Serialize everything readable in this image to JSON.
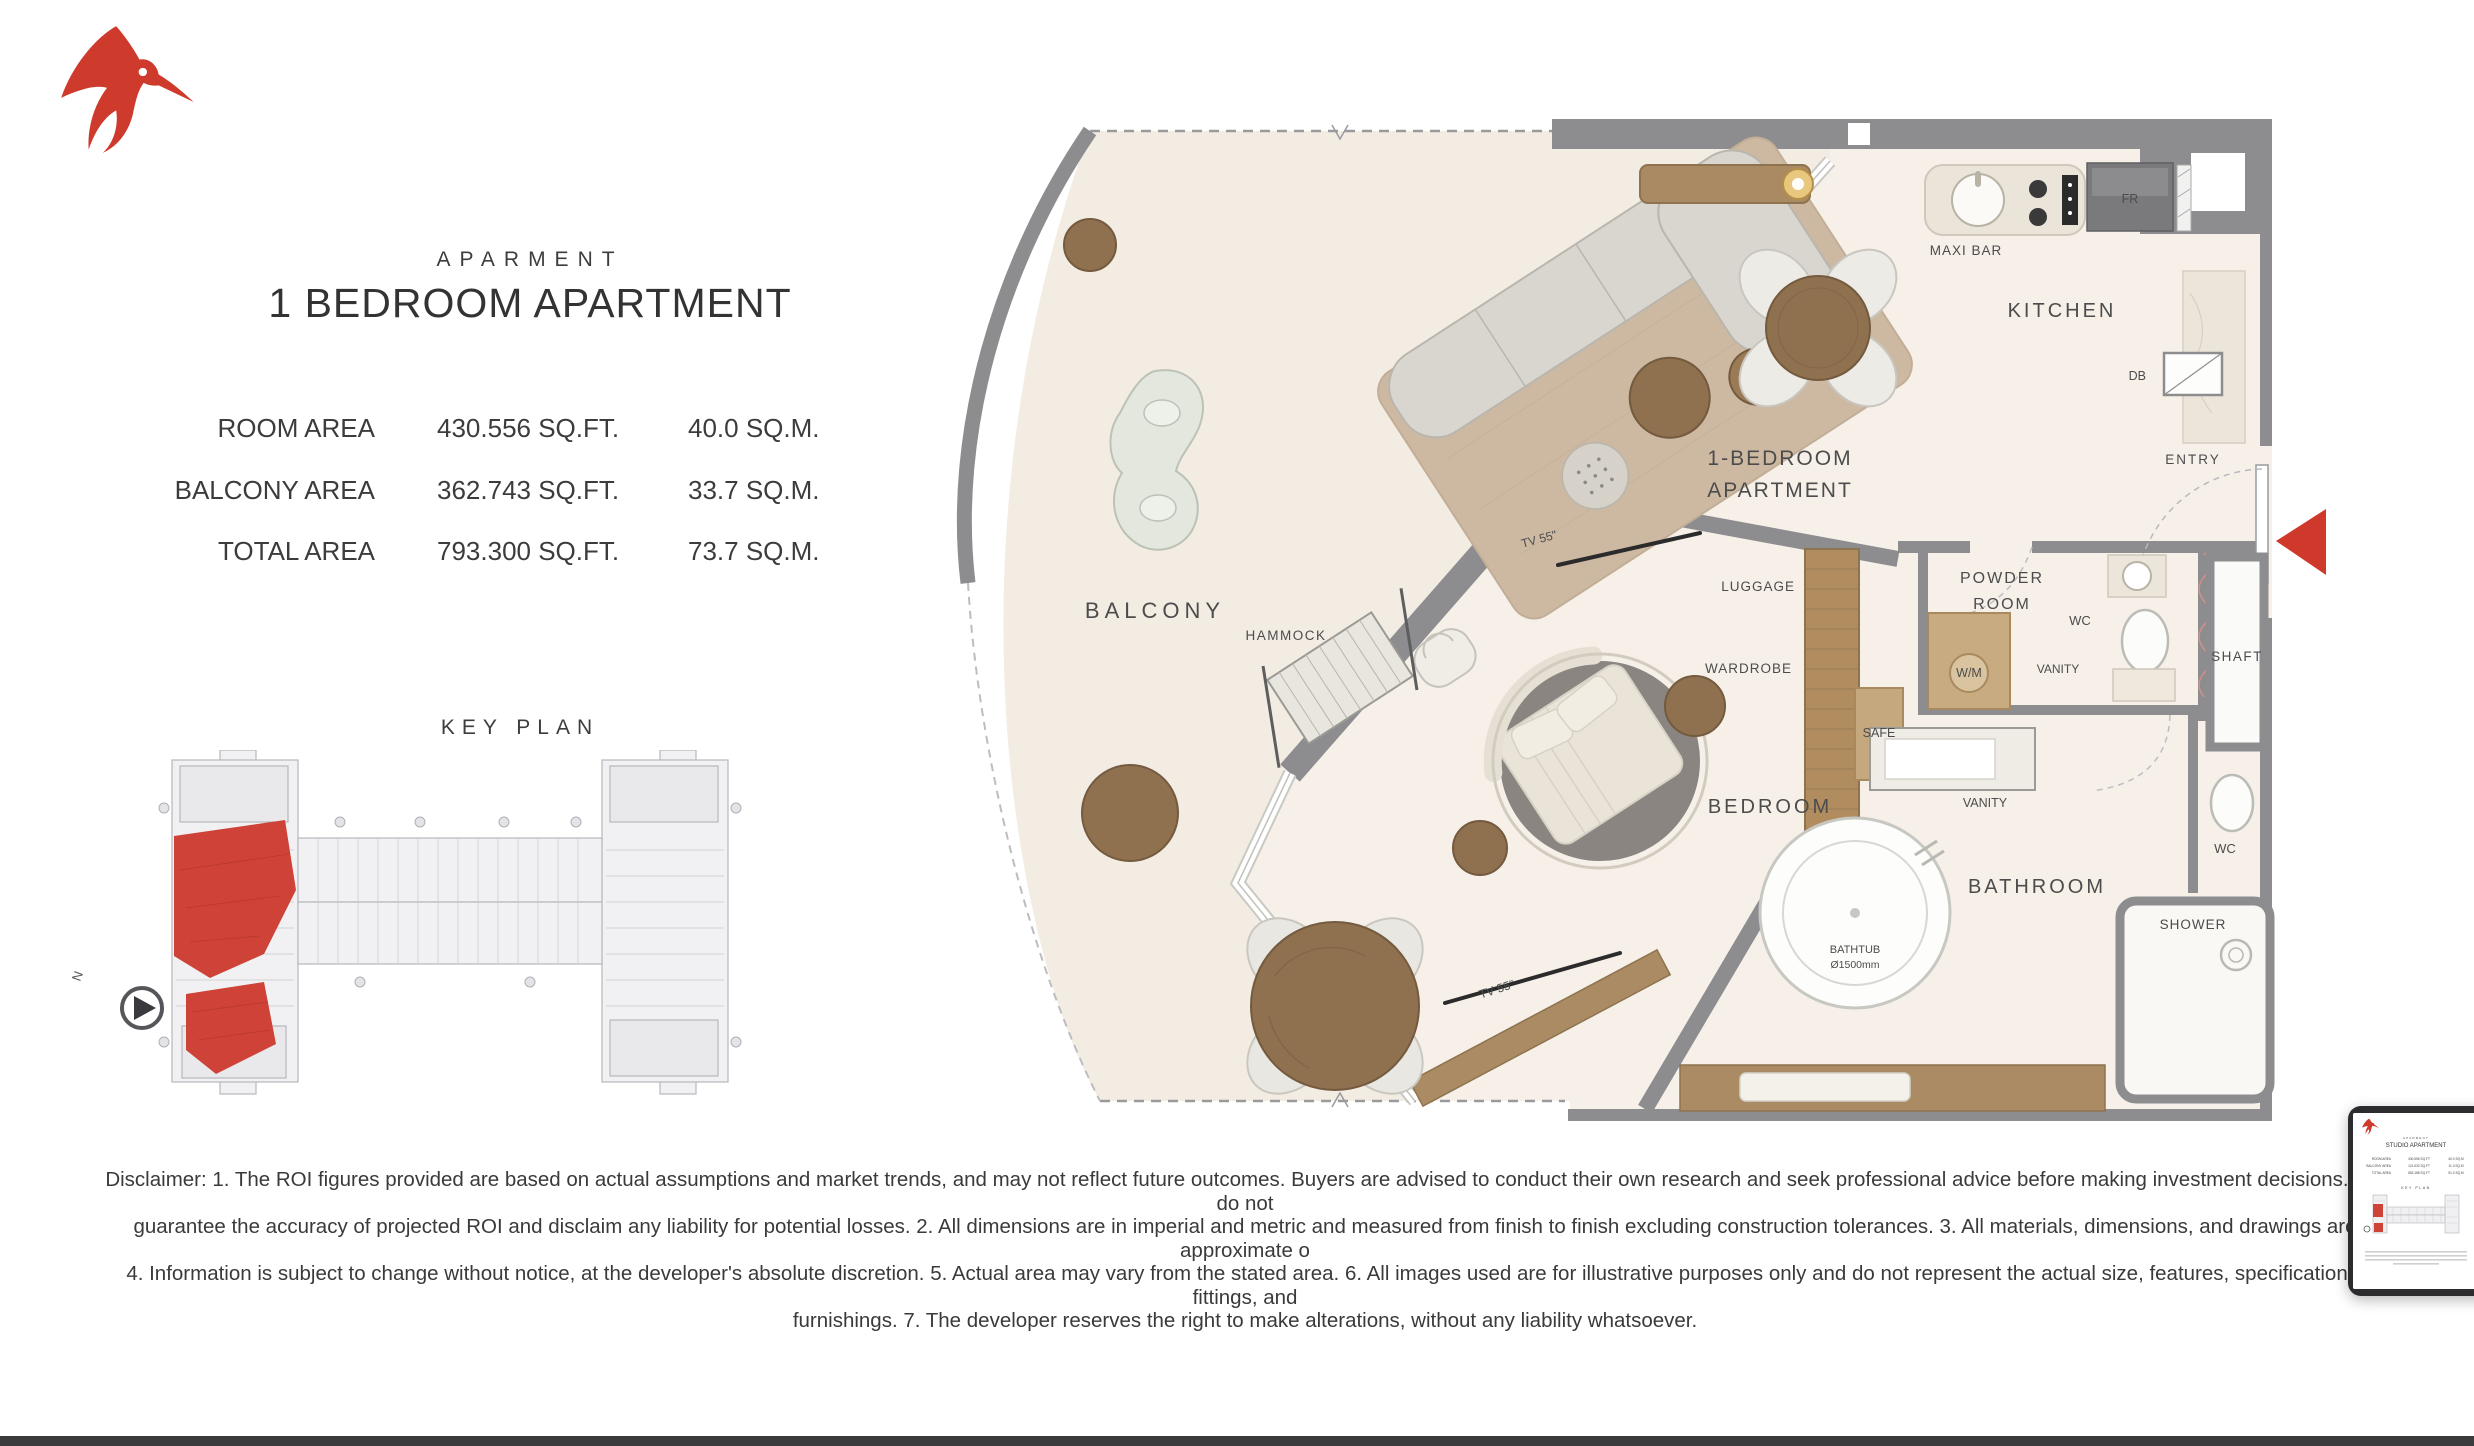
{
  "page": {
    "background": "#ffffff",
    "bottom_bar_color": "#3b3b3d"
  },
  "logo": {
    "icon": "hummingbird-logo",
    "color": "#ce3a2c"
  },
  "header": {
    "eyebrow": "APARMENT",
    "title": "1 BEDROOM APARTMENT"
  },
  "area_table": {
    "rows": [
      {
        "label": "ROOM AREA",
        "sqft": "430.556 SQ.FT.",
        "sqm": "40.0 SQ.M."
      },
      {
        "label": "BALCONY AREA",
        "sqft": "362.743 SQ.FT.",
        "sqm": "33.7 SQ.M."
      },
      {
        "label": "TOTAL AREA",
        "sqft": "793.300 SQ.FT.",
        "sqm": "73.7 SQ.M."
      }
    ]
  },
  "key_plan": {
    "title": "KEY PLAN",
    "north_label": "N",
    "highlight_color": "#ce4237"
  },
  "floor_plan": {
    "labels": {
      "balcony": "BALCONY",
      "hammock": "HAMMOCK",
      "tv_living": "TV 55\"",
      "tv_bedroom": "TV 55\"",
      "maxi_bar": "MAXI BAR",
      "kitchen": "KITCHEN",
      "fridge": "FR",
      "db": "DB",
      "entry": "ENTRY",
      "unit_line1": "1-BEDROOM",
      "unit_line2": "APARTMENT",
      "luggage": "LUGGAGE",
      "powder_line1": "POWDER",
      "powder_line2": "ROOM",
      "wc_powder": "WC",
      "shaft": "SHAFT",
      "wardrobe": "WARDROBE",
      "washing_machine": "W/M",
      "vanity_powder": "VANITY",
      "safe": "SAFE",
      "vanity_bath": "VANITY",
      "wc_bath": "WC",
      "bedroom": "BEDROOM",
      "bathroom": "BATHROOM",
      "shower": "SHOWER",
      "bathtub_line1": "BATHTUB",
      "bathtub_line2": "Ø1500mm"
    }
  },
  "disclaimer": {
    "lines": [
      "Disclaimer: 1. The ROI figures provided are based on actual assumptions and market trends, and may not reflect future outcomes. Buyers are advised to conduct their own research and seek professional advice before making investment decisions. We do not",
      "guarantee the accuracy of projected ROI and disclaim any liability for potential losses. 2. All dimensions are in imperial and metric and measured from finish to finish excluding construction tolerances. 3. All materials, dimensions, and drawings are approximate o",
      "4. Information is subject to change without notice, at the developer's absolute discretion. 5. Actual area may vary from the stated area. 6. All images used are for illustrative purposes only and do not represent the actual size, features, specifications, fittings, and",
      "furnishings. 7. The developer reserves the right to make alterations, without any liability whatsoever."
    ]
  },
  "thumbnail": {
    "eyebrow": "APARMENT",
    "title": "STUDIO APARTMENT",
    "key_plan_title": "KEY PLAN",
    "rows": [
      {
        "label": "ROOM AREA",
        "sqft": "430.556 SQ.FT",
        "sqm": "40.0 SQ.M"
      },
      {
        "label": "BALCONY AREA",
        "sqft": "121.632 SQ.FT",
        "sqm": "11.3 SQ.M"
      },
      {
        "label": "TOTAL AREA",
        "sqft": "552.188 SQ.FT",
        "sqm": "51.3 SQ.M"
      }
    ]
  }
}
